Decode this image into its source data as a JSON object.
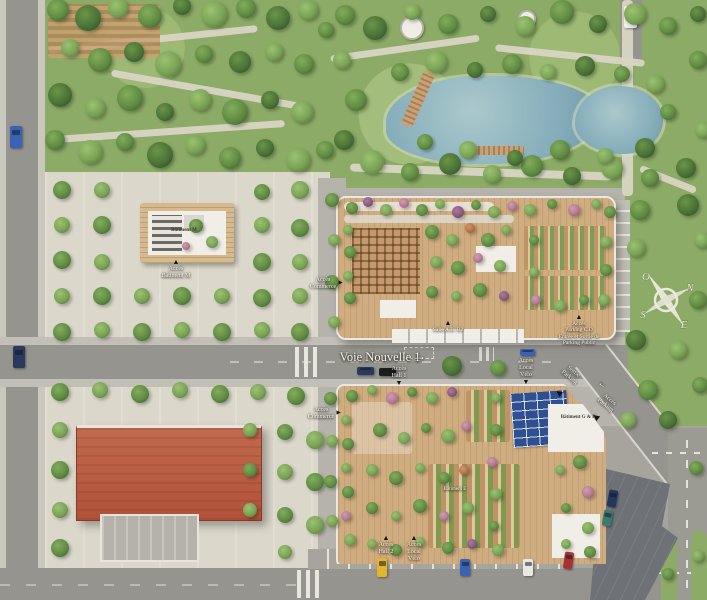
{
  "palette": {
    "grass": "#8cab66",
    "grass_light": "#9db974",
    "water": "#86aebb",
    "road": "#95948e",
    "road_light": "#a6a49d",
    "sidewalk": "#c2c0b6",
    "esplanade": "#dbd7ca",
    "surround": "#b5b3ac",
    "deck": "#cfad80",
    "roof_white": "#f0eee6",
    "roof_red": "#b25139",
    "solar_blue": "#2e4f91",
    "parking_dark": "#6e7277",
    "label_light": "#f7f5ee",
    "label_dark": "#3c3b33"
  },
  "icons": {
    "arrow_up": "▲",
    "arrow_down": "▼",
    "arrow_right": "►",
    "marker_left": "◀",
    "road_arrow": "→"
  },
  "compass": {
    "north": "N",
    "south": "S",
    "east": "E",
    "west": "O"
  },
  "labels": [
    {
      "name": "road-label-voie-nouvelle-1",
      "lines": [
        "Voie Nouvelle 1"
      ],
      "x": 380,
      "y": 350,
      "size": 12.5,
      "tone": "light"
    },
    {
      "name": "road-direction-arrow",
      "lines": [
        "→"
      ],
      "x": 420,
      "y": 349,
      "size": 12,
      "tone": "light"
    },
    {
      "name": "acces-batiment-m",
      "lines": [
        "Accès",
        "Bâtiment M"
      ],
      "x": 176,
      "y": 259,
      "size": 6,
      "tone": "light",
      "arrow": "up"
    },
    {
      "name": "batiment-m-label",
      "lines": [
        "Bâtiment M"
      ],
      "x": 184,
      "y": 228,
      "size": 5,
      "tone": "dark"
    },
    {
      "name": "acces-commerce-north",
      "lines": [
        "Accès",
        "Commerce"
      ],
      "x": 323,
      "y": 277,
      "size": 6,
      "tone": "light",
      "arrow": "right"
    },
    {
      "name": "acces-commerce-south",
      "lines": [
        "Accès",
        "Commerce"
      ],
      "x": 321,
      "y": 407,
      "size": 6,
      "tone": "light",
      "arrow": "right"
    },
    {
      "name": "salle-ab-b2",
      "lines": [
        "Salle A.B. B2"
      ],
      "x": 448,
      "y": 320,
      "size": 5.5,
      "tone": "light",
      "arrow": "up"
    },
    {
      "name": "acces-parking-cd",
      "lines": [
        "Accès",
        "Parking C.D",
        "Entrée et Sortie de",
        "Parking Public"
      ],
      "x": 579,
      "y": 314,
      "size": 5.5,
      "tone": "light",
      "arrow": "up"
    },
    {
      "name": "acces-hall-1",
      "lines": [
        "Accès",
        "Hall 1"
      ],
      "x": 399,
      "y": 366,
      "size": 6,
      "tone": "light",
      "arrow": "down"
    },
    {
      "name": "acces-local-velo-north",
      "lines": [
        "Accès",
        "Local",
        "Vélo"
      ],
      "x": 526,
      "y": 358,
      "size": 6,
      "tone": "light",
      "arrow": "down"
    },
    {
      "name": "acces-hall-2",
      "lines": [
        "Accès",
        "Hall 2"
      ],
      "x": 386,
      "y": 535,
      "size": 6,
      "tone": "light",
      "arrow": "up"
    },
    {
      "name": "acces-local-velo-south",
      "lines": [
        "Accès",
        "Local",
        "Vélo"
      ],
      "x": 414,
      "y": 535,
      "size": 6,
      "tone": "light",
      "arrow": "up"
    },
    {
      "name": "sortie-parking",
      "lines": [
        "Sortie",
        "Parking"
      ],
      "x": 571,
      "y": 368,
      "size": 6,
      "tone": "light",
      "rotate": 38
    },
    {
      "name": "acces-parking",
      "lines": [
        "Accès",
        "Parking"
      ],
      "x": 607,
      "y": 396,
      "size": 6,
      "tone": "light",
      "rotate": 38
    },
    {
      "name": "parking-marker-1",
      "lines": [
        "◀"
      ],
      "x": 559,
      "y": 388,
      "size": 8,
      "tone": "black",
      "rotate": 38
    },
    {
      "name": "parking-marker-2",
      "lines": [
        "◀"
      ],
      "x": 596,
      "y": 412,
      "size": 8,
      "tone": "black",
      "rotate": 38
    },
    {
      "name": "diag-lane-arrow",
      "lines": [
        "→"
      ],
      "x": 601,
      "y": 381,
      "size": 9,
      "tone": "light",
      "rotate": 218
    },
    {
      "name": "batiment-g-f",
      "lines": [
        "Bâtiment G & F"
      ],
      "x": 578,
      "y": 415,
      "size": 5,
      "tone": "dark"
    },
    {
      "name": "batiment-e",
      "lines": [
        "Bâtiment E"
      ],
      "x": 455,
      "y": 487,
      "size": 5,
      "tone": "light"
    }
  ]
}
